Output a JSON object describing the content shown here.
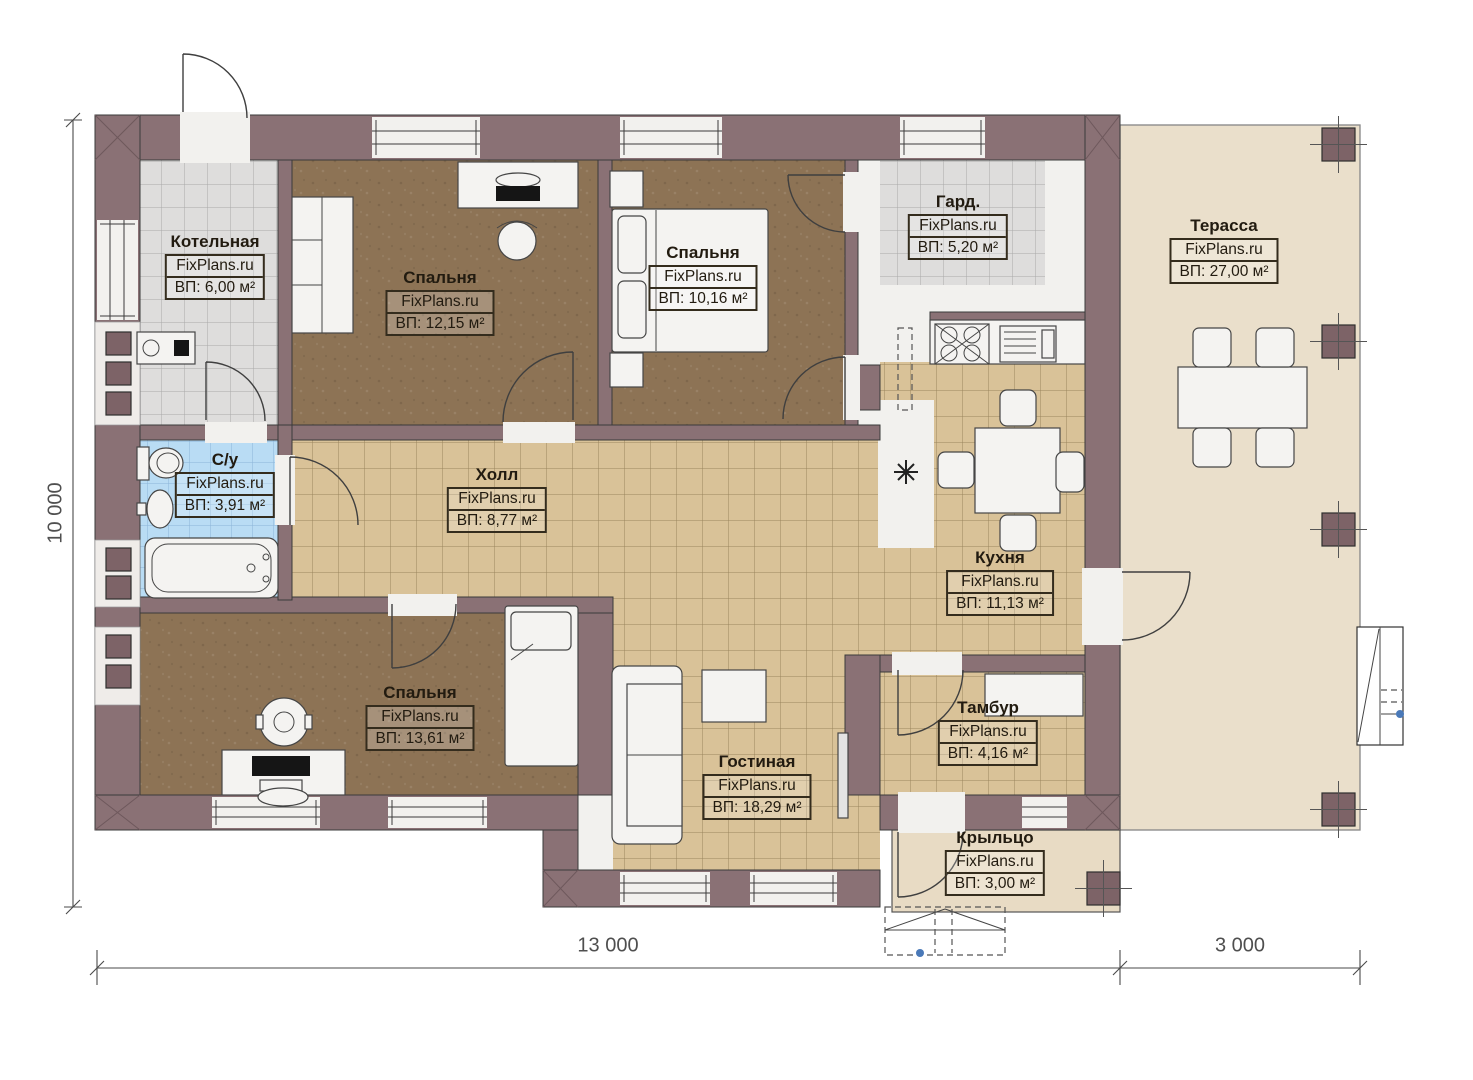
{
  "page": {
    "type": "floor-plan",
    "background": "#ffffff"
  },
  "dimensions": {
    "left_height": "10 000",
    "bottom_main_width": "13 000",
    "bottom_terrace_width": "3 000"
  },
  "colors": {
    "wall": "#8a7175",
    "wall_dark": "#7d6367",
    "outline": "#3a3a3a",
    "white_floor": "#f2f1ee",
    "tile_tan": "#d9c298",
    "tile_tan_line": "#9a855e",
    "tile_gray": "#dedddc",
    "tile_gray_line": "#a9a9a9",
    "tile_blue": "#b9dcf4",
    "tile_blue_line": "#8cb4d8",
    "floor_brown": "#8d7355",
    "terrace_floor": "#eadfcb",
    "porch_floor": "#e8dbc4",
    "furniture_fill": "#f4f3f1",
    "accent_dot": "#4a79b8",
    "dim_text": "#4f4f4f",
    "label_text": "#221b10"
  },
  "rooms": [
    {
      "id": "kotelnaya",
      "name": "Котельная",
      "watermark": "FixPlans.ru",
      "area": "ВП: 6,00 м²",
      "label": {
        "x": 215,
        "y": 232
      }
    },
    {
      "id": "bedroom-1",
      "name": "Спальня",
      "watermark": "FixPlans.ru",
      "area": "ВП: 12,15 м²",
      "label": {
        "x": 440,
        "y": 268
      }
    },
    {
      "id": "bedroom-2",
      "name": "Спальня",
      "watermark": "FixPlans.ru",
      "area": "ВП: 10,16 м²",
      "label": {
        "x": 703,
        "y": 243
      }
    },
    {
      "id": "garderob",
      "name": "Гард.",
      "watermark": "FixPlans.ru",
      "area": "ВП: 5,20 м²",
      "label": {
        "x": 958,
        "y": 192
      }
    },
    {
      "id": "terrace",
      "name": "Терасса",
      "watermark": "FixPlans.ru",
      "area": "ВП: 27,00 м²",
      "label": {
        "x": 1224,
        "y": 216
      }
    },
    {
      "id": "bathroom",
      "name": "С/у",
      "watermark": "FixPlans.ru",
      "area": "ВП: 3,91 м²",
      "label": {
        "x": 225,
        "y": 450
      }
    },
    {
      "id": "hall",
      "name": "Холл",
      "watermark": "FixPlans.ru",
      "area": "ВП: 8,77 м²",
      "label": {
        "x": 497,
        "y": 465
      }
    },
    {
      "id": "kitchen",
      "name": "Кухня",
      "watermark": "FixPlans.ru",
      "area": "ВП: 11,13 м²",
      "label": {
        "x": 1000,
        "y": 548
      }
    },
    {
      "id": "bedroom-3",
      "name": "Спальня",
      "watermark": "FixPlans.ru",
      "area": "ВП: 13,61 м²",
      "label": {
        "x": 420,
        "y": 683
      }
    },
    {
      "id": "living",
      "name": "Гостиная",
      "watermark": "FixPlans.ru",
      "area": "ВП: 18,29 м²",
      "label": {
        "x": 757,
        "y": 752
      }
    },
    {
      "id": "tambur",
      "name": "Тамбур",
      "watermark": "FixPlans.ru",
      "area": "ВП: 4,16 м²",
      "label": {
        "x": 988,
        "y": 698
      }
    },
    {
      "id": "porch",
      "name": "Крыльцо",
      "watermark": "FixPlans.ru",
      "area": "ВП: 3,00 м²",
      "label": {
        "x": 995,
        "y": 828
      }
    }
  ]
}
